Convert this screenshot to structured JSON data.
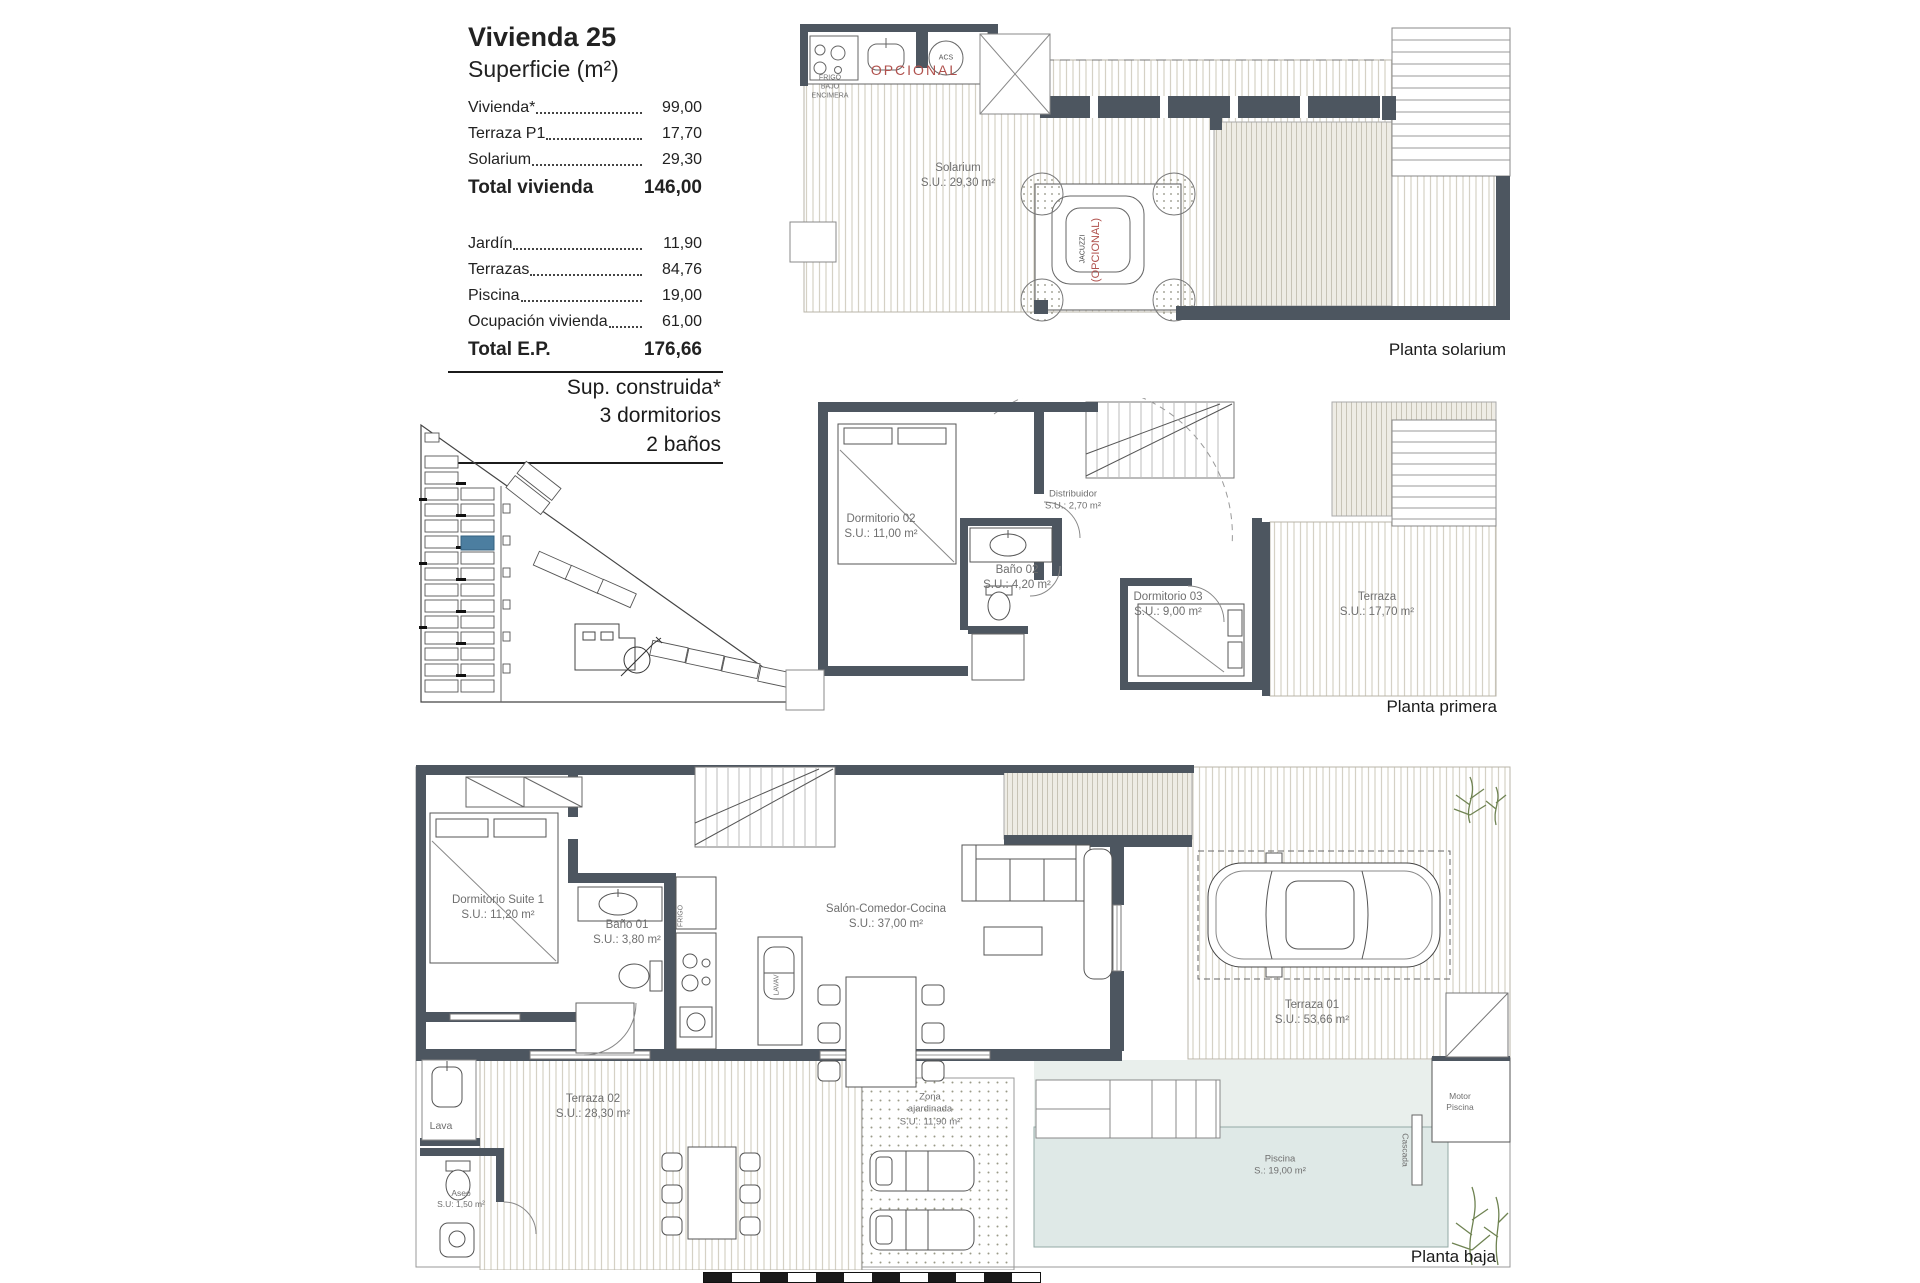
{
  "panel": {
    "title": "Vivienda 25",
    "subtitle": "Superficie (m²)",
    "rows_top": [
      {
        "label": "Vivienda*",
        "value": "99,00"
      },
      {
        "label": "Terraza P1",
        "value": "17,70"
      },
      {
        "label": "Solarium",
        "value": "29,30"
      }
    ],
    "total_vivienda": {
      "label": "Total vivienda",
      "value": "146,00"
    },
    "rows_bottom": [
      {
        "label": "Jardín",
        "value": "11,90"
      },
      {
        "label": "Terrazas",
        "value": "84,76"
      },
      {
        "label": "Piscina",
        "value": "19,00"
      },
      {
        "label": "Ocupación vivienda",
        "value": "61,00"
      }
    ],
    "total_ep": {
      "label": "Total E.P.",
      "value": "176,66"
    },
    "built_lines": [
      "Sup. construida*",
      "3 dormitorios",
      "2 baños"
    ]
  },
  "plans": {
    "solarium": {
      "caption": "Planta solarium",
      "room_name": "Solarium",
      "room_area": "S.U.: 29,30 m²",
      "opcional": "OPCIONAL",
      "frigo_line1": "FRIGO",
      "frigo_line2": "BAJO",
      "frigo_line3": "ENCIMERA",
      "acs": "ACS",
      "jacuzzi": "JACUZZI",
      "jacuzzi_opcional": "(OPCIONAL)"
    },
    "primera": {
      "caption": "Planta primera",
      "rooms": [
        {
          "name": "Dormitorio 02",
          "area": "S.U.: 11,00 m²"
        },
        {
          "name": "Distribuidor",
          "area": "S.U.: 2,70 m²"
        },
        {
          "name": "Baño 02",
          "area": "S.U.: 4,20 m²"
        },
        {
          "name": "Dormitorio 03",
          "area": "S.U.: 9,00 m²"
        },
        {
          "name": "Terraza",
          "area": "S.U.: 17,70 m²"
        }
      ]
    },
    "baja": {
      "caption": "Planta baja",
      "rooms": [
        {
          "name": "Dormitorio Suite 1",
          "area": "S.U.: 11,20 m²"
        },
        {
          "name": "Baño 01",
          "area": "S.U.: 3,80 m²"
        },
        {
          "name": "Salón-Comedor-Cocina",
          "area": "S.U.: 37,00 m²"
        },
        {
          "name": "Terraza 01",
          "area": "S.U.: 53,66 m²"
        },
        {
          "name": "Terraza 02",
          "area": "S.U.: 28,30 m²"
        },
        {
          "name": "Piscina",
          "area": "S.: 19,00 m²"
        },
        {
          "name": "Aseo",
          "area": "S.U: 1,50 m²"
        }
      ],
      "zona_line1": "Zona",
      "zona_line2": "ajardinada",
      "zona_area": "S.U.: 11,90 m²",
      "lava": "Lava",
      "motor_line1": "Motor",
      "motor_line2": "Piscina",
      "cascada": "Cascada",
      "frigo": "FRIGO",
      "lavav": "LAVAV"
    }
  },
  "colors": {
    "wall": "#4d5660",
    "deck_stripe": "#d5d1c5",
    "pool": "#dfe9e7",
    "highlight_unit": "#4c7ea0",
    "optional_red": "#b0514d",
    "plant_green": "#6f8352",
    "label_grey": "#6f6f6f"
  }
}
